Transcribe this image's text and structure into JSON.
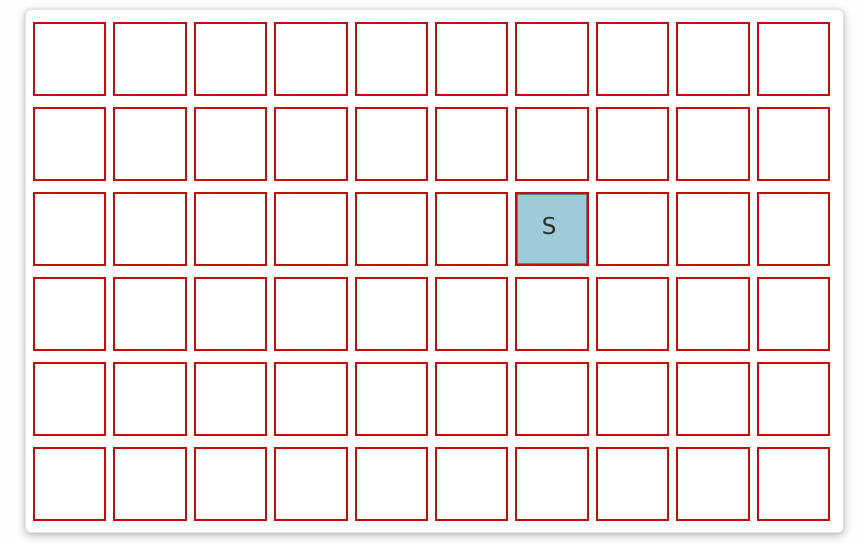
{
  "board": {
    "rows": 6,
    "columns": 10,
    "cells_total": 60,
    "cell_border_color": "#c20d0d",
    "cell_fill_color": "#ffffff",
    "highlighted_cell": {
      "row": 3,
      "column": 7,
      "label": "S",
      "fill_color": "#9fcbd9",
      "label_color": "#2e2e2e"
    }
  }
}
